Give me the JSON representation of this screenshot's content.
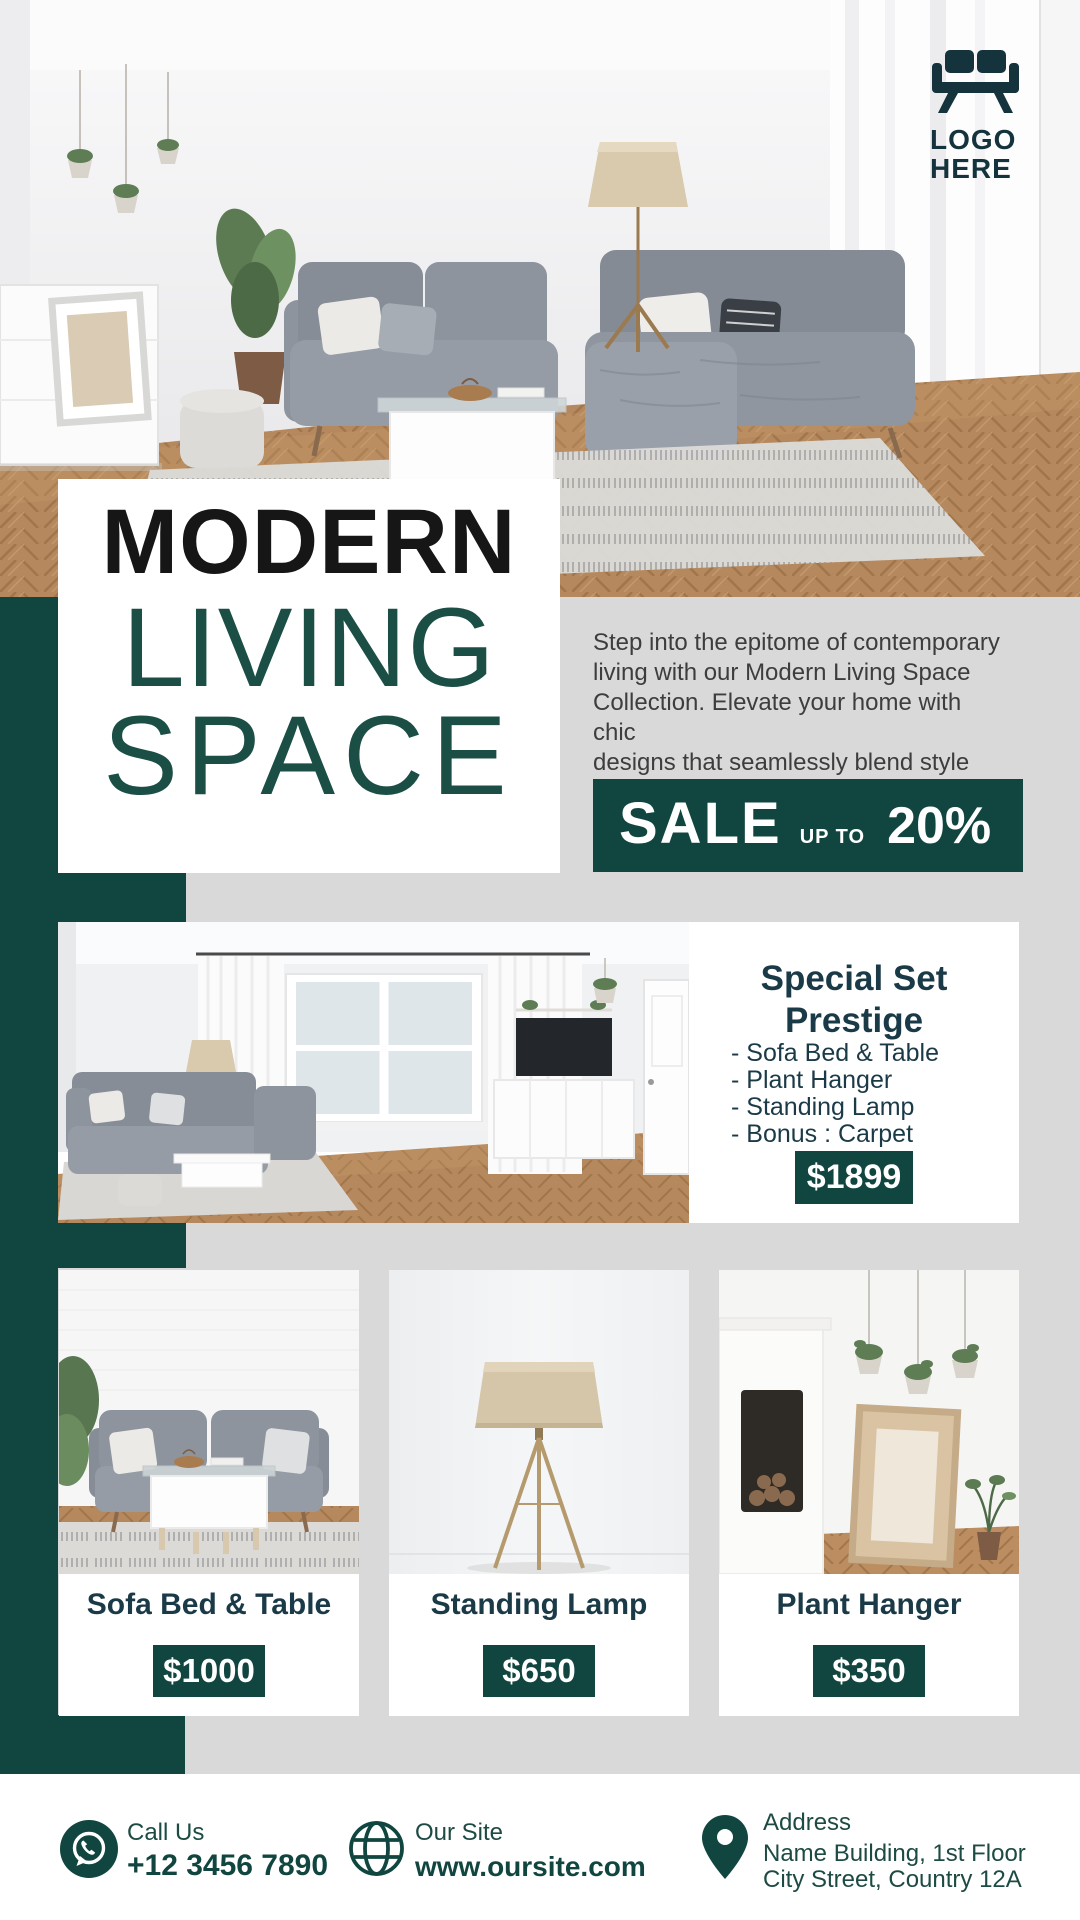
{
  "logo": {
    "line1": "LOGO",
    "line2": "HERE"
  },
  "hero": {
    "title_line1": "MODERN",
    "title_line2": "LIVING",
    "title_line3": "SPACE"
  },
  "intro": {
    "paragraph": "Step into the epitome of contemporary\nliving with our Modern Living Space\nCollection. Elevate your home with chic\ndesigns that seamlessly blend style and\ncomfort."
  },
  "sale": {
    "label": "SALE",
    "qualifier": "UP TO",
    "amount": "20%"
  },
  "special_set": {
    "title": "Special Set\nPrestige",
    "items": [
      "- Sofa Bed & Table",
      "- Plant Hanger",
      "- Standing Lamp",
      "- Bonus : Carpet"
    ],
    "price": "$1899"
  },
  "products": [
    {
      "name": "Sofa Bed & Table",
      "price": "$1000"
    },
    {
      "name": "Standing Lamp",
      "price": "$650"
    },
    {
      "name": "Plant Hanger",
      "price": "$350"
    }
  ],
  "footer": {
    "call": {
      "label": "Call Us",
      "value": "+12 3456 7890"
    },
    "site": {
      "label": "Our Site",
      "value": "www.oursite.com"
    },
    "address": {
      "label": "Address",
      "line1": "Name Building, 1st Floor",
      "line2": "City Street, Country 12A"
    }
  },
  "colors": {
    "teal": "#114640",
    "heading": "#1b3a47",
    "body_text": "#3d3d3d",
    "background": "#d9d9d9"
  }
}
